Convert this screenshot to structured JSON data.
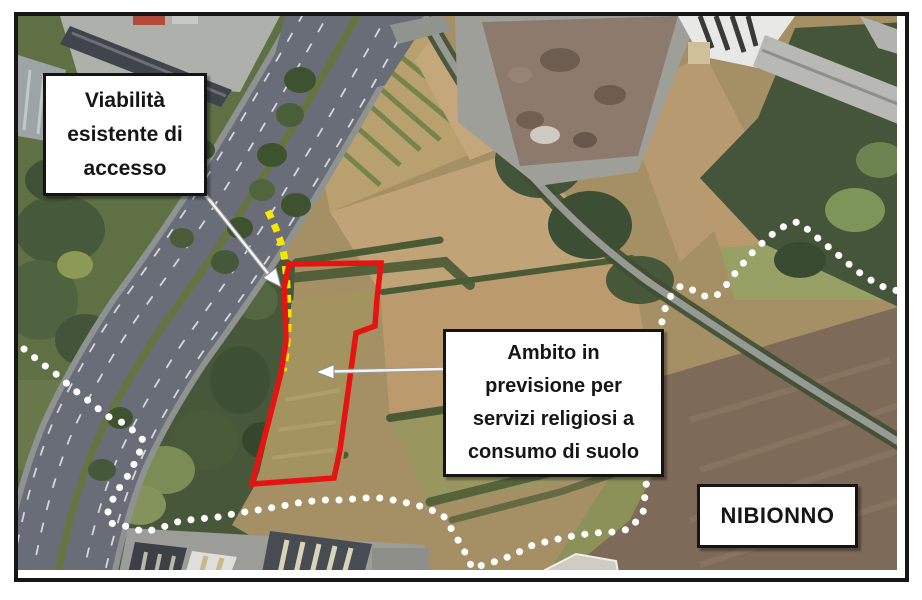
{
  "figure": {
    "type": "annotated-aerial-map",
    "municipality_label": "NIBIONNO",
    "callouts": {
      "viability": {
        "lines": [
          "Viabilità",
          "esistente di",
          "accesso"
        ]
      },
      "ambito": {
        "lines": [
          "Ambito in",
          "previsione per",
          "servizi religiosi a",
          "consumo di suolo"
        ]
      }
    },
    "legend": {
      "planned_area_outline_color": "#e61310",
      "existing_access_road_color": "#f6e600",
      "municipal_boundary_color": "#ffffff"
    },
    "watermark": "Google"
  }
}
